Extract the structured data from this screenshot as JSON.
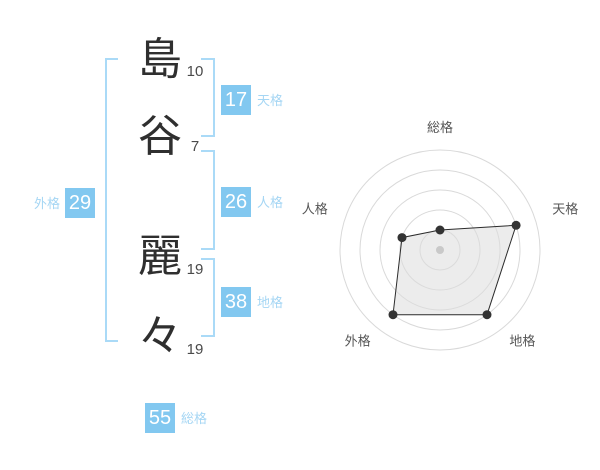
{
  "page": {
    "background": "#ffffff"
  },
  "colors": {
    "badge_blue": "#82c8f0",
    "bracket_blue": "#aadaf7",
    "kaku_label_blue": "#a5d6f4",
    "kanji_dark": "#2f2f2f",
    "stroke_count_gray": "#4a4a4a",
    "chart_ring_gray": "#d9d9d9",
    "chart_label_gray": "#555555",
    "chart_polygon_fill": "#dddddd",
    "chart_polygon_stroke": "#2b2b2b",
    "chart_point_dark": "#333333",
    "chart_center_dot_gray": "#c9c9c9"
  },
  "name": {
    "full": "島谷 麗々",
    "chars": [
      {
        "char": "島",
        "strokes": "10"
      },
      {
        "char": "谷",
        "strokes": "7"
      },
      {
        "char": "麗",
        "strokes": "19"
      },
      {
        "char": "々",
        "strokes": "19"
      }
    ]
  },
  "kaku": {
    "tenkaku": {
      "label": "天格",
      "value": "17"
    },
    "jinkaku": {
      "label": "人格",
      "value": "26"
    },
    "chikaku": {
      "label": "地格",
      "value": "38"
    },
    "gaikaku": {
      "label": "外格",
      "value": "29"
    },
    "soukaku": {
      "label": "総格",
      "value": "55"
    }
  },
  "chart_data": {
    "type": "radar",
    "categories": [
      "総格",
      "天格",
      "地格",
      "外格",
      "人格"
    ],
    "values": [
      20,
      80,
      80,
      80,
      40
    ],
    "max": 100,
    "rings": 5,
    "start_angle_deg": 90,
    "direction": "clockwise",
    "grid": "circular-no-spokes",
    "legend": "none",
    "title": ""
  }
}
